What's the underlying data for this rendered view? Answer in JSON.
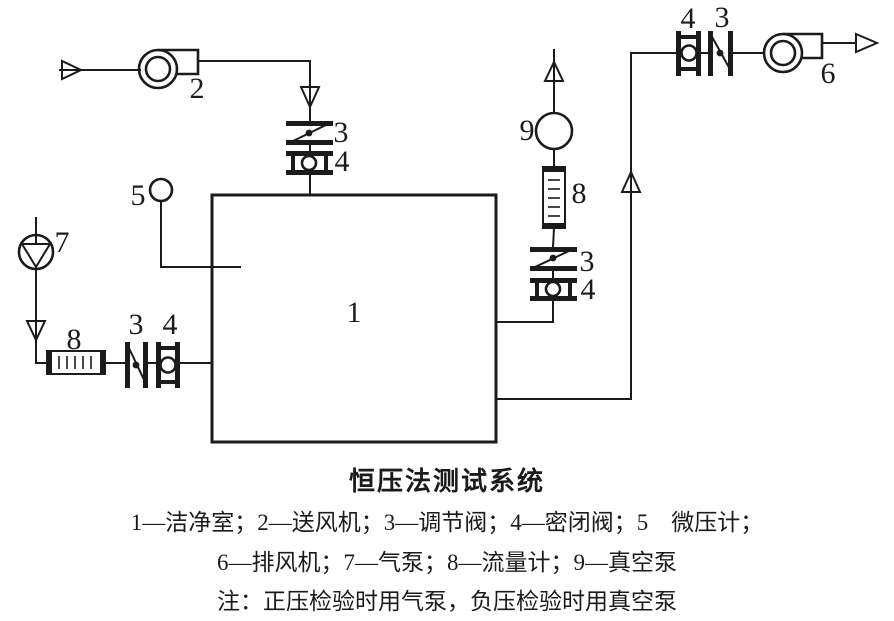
{
  "colors": {
    "ink": "#1b1b1b",
    "paper": "#ffffff"
  },
  "diagram": {
    "labels": {
      "clean_room": "1",
      "supply_fan": "2",
      "top_reg_valve": "3",
      "top_seal_valve": "4",
      "micro_manometer": "5",
      "exhaust_fan": "6",
      "air_pump": "7",
      "left_flow_meter": "8",
      "left_reg_valve": "3",
      "left_seal_valve": "4",
      "vacuum_pump": "9",
      "right_flow_meter": "8",
      "right_reg_valve": "3",
      "right_seal_valve": "4",
      "out_seal_valve": "4",
      "out_reg_valve": "3"
    }
  },
  "caption": {
    "title": "恒压法测试系统",
    "legend_line1": "1—洁净室；2—送风机；3—调节阀；4—密闭阀；5　微压计；",
    "legend_line2": "6—排风机；7—气泵；8—流量计；9—真空泵",
    "note": "注：正压检验时用气泵，负压检验时用真空泵"
  }
}
